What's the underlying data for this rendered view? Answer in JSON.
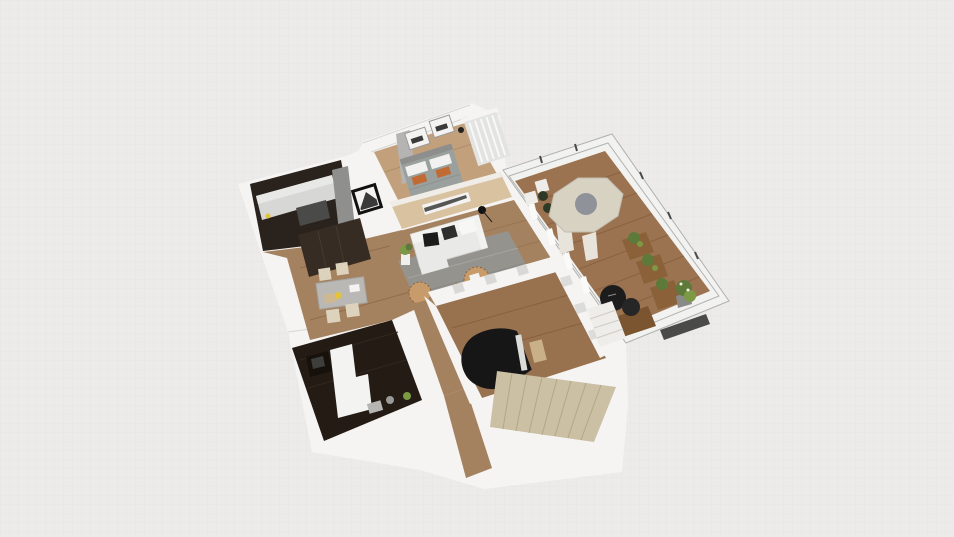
{
  "app": {
    "viewport_label": "3D floor plan render",
    "scene_description": "Top-down isometric 3D render of a furnished apartment with kitchen, bedroom, living room, dining area, home office, piano room, staircase and a large outdoor deck with glass railing"
  },
  "rooms": [
    {
      "id": "kitchen",
      "label": "Kitchen"
    },
    {
      "id": "bedroom",
      "label": "Bedroom"
    },
    {
      "id": "living-room",
      "label": "Living Room"
    },
    {
      "id": "dining-area",
      "label": "Dining Area"
    },
    {
      "id": "home-office",
      "label": "Home Office"
    },
    {
      "id": "piano-room",
      "label": "Piano Room"
    },
    {
      "id": "staircase",
      "label": "Staircase"
    },
    {
      "id": "deck",
      "label": "Deck / Balcony"
    }
  ],
  "furniture": [
    "kitchen-counter",
    "tall-cabinet",
    "cooktop",
    "bed",
    "wall-art-frames",
    "media-wood-wall",
    "sofa",
    "area-rug",
    "woven-poufs",
    "arc-lamp",
    "dining-table",
    "dining-chairs",
    "wardrobe",
    "desk-with-monitor",
    "grand-piano",
    "piano-bench",
    "patio-table",
    "patio-chairs",
    "planter-boxes",
    "round-lounge-chairs",
    "potted-plant",
    "deck-steps"
  ],
  "colors": {
    "background": "#ecebe9",
    "grid_line": "#e2e1df",
    "wall_white": "#f5f4f2",
    "wall_gray": "#b5b4b2",
    "wood_wall": "#d9c2a0",
    "bedroom_floor": "#c2a07b",
    "wood_floor": "#a5825f",
    "wood_floor_dark": "#98714f",
    "deck_floor": "#9c7351",
    "kitchen_dark": "#2a221c",
    "counter_light": "#d7d7d5",
    "counter_face": "#e8e8e6",
    "cabinet_gray": "#8f8f8d",
    "stove_gray": "#4a4a48",
    "office_dark": "#241b14",
    "office_white": "#f3f3f1",
    "desk_black": "#17110c",
    "monitor_gray": "#3e3e3c",
    "rug_gray": "#95938e",
    "sofa_white": "#e9e9e7",
    "sofa_back": "#f2f2f0",
    "pillow_black": "#1c1c1c",
    "pillow_gray": "#2e2e2e",
    "bed_gray": "#9aa09e",
    "headboard_gray": "#8e8e8c",
    "pillow_white": "#f1f1ef",
    "accent_orange": "#c26a33",
    "table_gray": "#b9b8b5",
    "chair_cream": "#ddd3bd",
    "wardrobe_dark": "#362c24",
    "stairs_beige": "#cbbfa4",
    "patio_table": "#d8d2c3",
    "patio_table_center": "#878b93",
    "patio_leg": "#e8e4dc",
    "plant_green": "#5d7a3a",
    "plant_green_light": "#7c9a44",
    "plant_dark": "#2f3a26",
    "planter_wood": "#8a6138",
    "piano_black": "#161616",
    "piano_keys": "#dcdcda",
    "bench_tan": "#c9b089",
    "pouf_tan": "#c89b6a",
    "frame_black": "#111111",
    "frame_inner": "#f4f3f1",
    "glass_frame": "#f2f2f0",
    "step_white": "#efede9",
    "bench_dark": "#4a4a48",
    "item_yellow": "#e3c437",
    "tray_tan": "#cdb892",
    "pot_white": "#f0efed",
    "pot_gray": "#8a8a88",
    "slat_panel": "#e3e3e1",
    "art_dark": "#3a3a3a"
  }
}
